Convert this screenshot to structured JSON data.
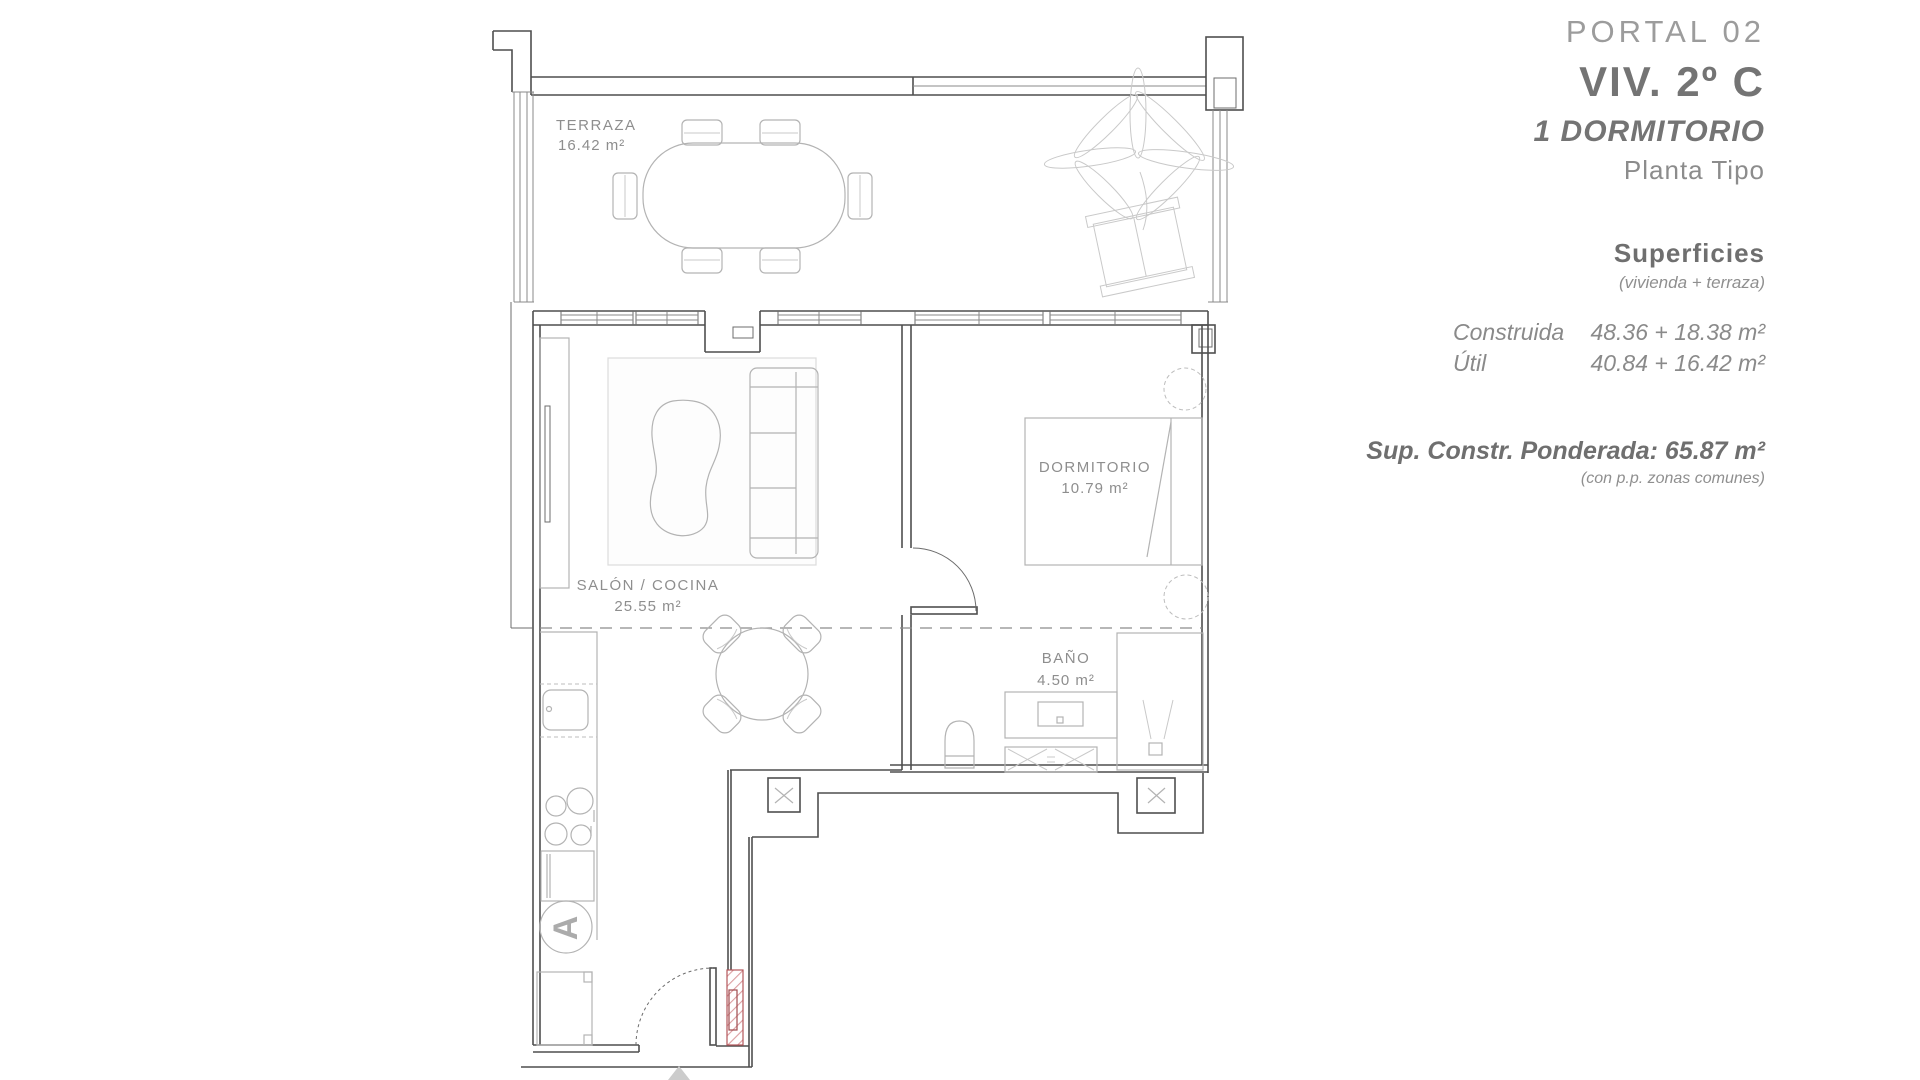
{
  "header": {
    "portal": "PORTAL 02",
    "unit": "VIV. 2º C",
    "type": "1 DORMITORIO",
    "floor": "Planta Tipo"
  },
  "surfaces": {
    "title": "Superficies",
    "subtitle": "(vivienda + terraza)",
    "rows": [
      {
        "label": "Construida",
        "value": "48.36 + 18.38 m²"
      },
      {
        "label": "Útil",
        "value": "40.84 + 16.42 m²"
      }
    ],
    "weighted": "Sup. Constr. Ponderada: 65.87 m²",
    "weighted_note": "(con p.p. zonas comunes)"
  },
  "plan": {
    "rooms": [
      {
        "name": "TERRAZA",
        "area": "16.42 m²"
      },
      {
        "name": "SALÓN / COCINA",
        "area": "25.55 m²"
      },
      {
        "name": "DORMITORIO",
        "area": "10.79 m²"
      },
      {
        "name": "BAÑO",
        "area": "4.50 m²"
      }
    ],
    "appliance_mark": "A"
  },
  "colors": {
    "wall": "#4f4f4f",
    "furniture": "#b3b3b3",
    "label_text": "#8e8e8e",
    "entry_hatch_line": "#dc9ea1",
    "entry_hatch_border": "#b4565a"
  }
}
